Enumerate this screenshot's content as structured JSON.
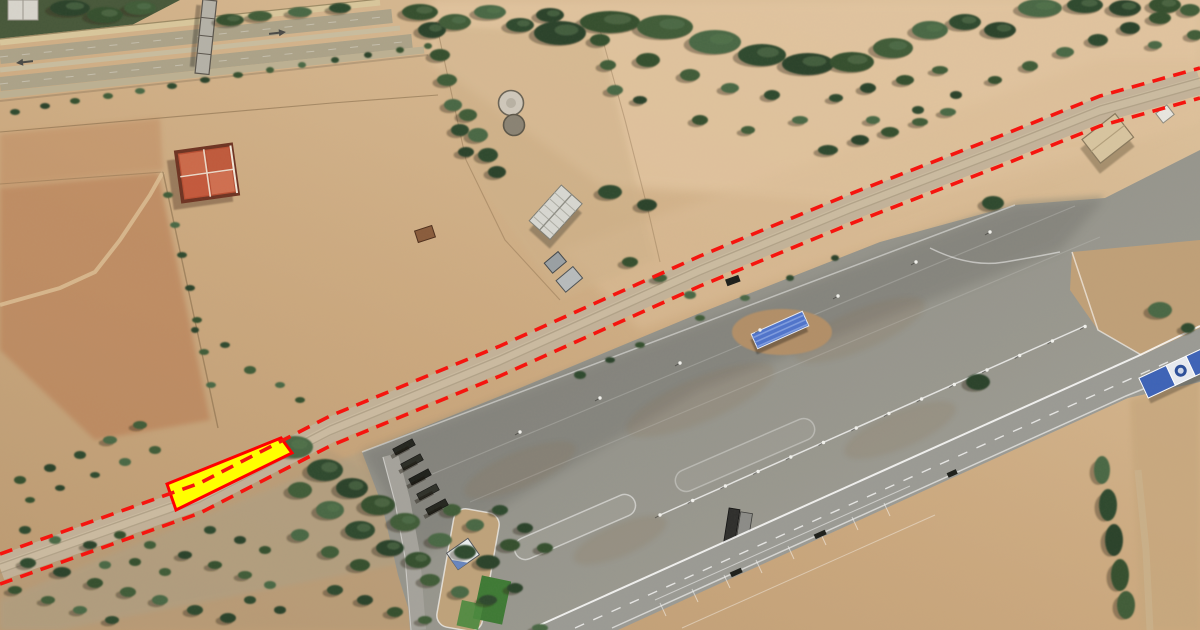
{
  "map": {
    "kind": "satellite-aerial-imagery",
    "canvas": {
      "width": 1200,
      "height": 630
    },
    "annotations": {
      "highlighted_parcel": {
        "shape": "polygon",
        "points": [
          [
            167,
            484
          ],
          [
            281,
            438
          ],
          [
            292,
            453
          ],
          [
            176,
            510
          ]
        ],
        "fill": "#ffff00",
        "fill_opacity": 1,
        "stroke": "#ff0000",
        "stroke_width": 3
      },
      "boundary_line_north": {
        "shape": "polyline",
        "points": [
          [
            0,
            554
          ],
          [
            200,
            483
          ],
          [
            330,
            416
          ],
          [
            500,
            346
          ],
          [
            700,
            256
          ],
          [
            850,
            194
          ],
          [
            1000,
            136
          ],
          [
            1100,
            96
          ],
          [
            1200,
            68
          ]
        ],
        "stroke": "#f5150f",
        "stroke_width": 3.6,
        "dash": "13 8.5"
      },
      "boundary_line_south": {
        "shape": "polyline",
        "points": [
          [
            0,
            584
          ],
          [
            200,
            513
          ],
          [
            330,
            446
          ],
          [
            500,
            376
          ],
          [
            700,
            286
          ],
          [
            850,
            224
          ],
          [
            1000,
            166
          ],
          [
            1100,
            126
          ],
          [
            1200,
            98
          ]
        ],
        "stroke": "#f5150f",
        "stroke_width": 3.6,
        "dash": "13 8.5"
      }
    },
    "palette": {
      "dirt_base": "#c9a67d",
      "dirt_light": "#e2c5a0",
      "field_red": "#b97e55",
      "asphalt": "#94948d",
      "road_track": "#c2b29a",
      "tree_dark": "#2c422c",
      "grass_patch": "#3e7a35",
      "roof_orange": "#c65a3a",
      "roof_blue": "#4f74cc",
      "canopy_blue": "#3d63b8"
    },
    "features": [
      {
        "name": "divided-highway"
      },
      {
        "name": "pedestrian-overpass"
      },
      {
        "name": "walled-field-compound"
      },
      {
        "name": "orange-roof-building"
      },
      {
        "name": "farm-warehouse"
      },
      {
        "name": "storage-tanks"
      },
      {
        "name": "dirt-road-corridor"
      },
      {
        "name": "tree-cluster"
      },
      {
        "name": "olive-grove"
      },
      {
        "name": "paved-terminal-area"
      },
      {
        "name": "blue-roof-building"
      },
      {
        "name": "service-island-shed"
      },
      {
        "name": "dark-utility-building"
      },
      {
        "name": "tan-building"
      },
      {
        "name": "entrance-canopy"
      },
      {
        "name": "marked-roadway"
      },
      {
        "name": "parked-trucks"
      }
    ]
  }
}
